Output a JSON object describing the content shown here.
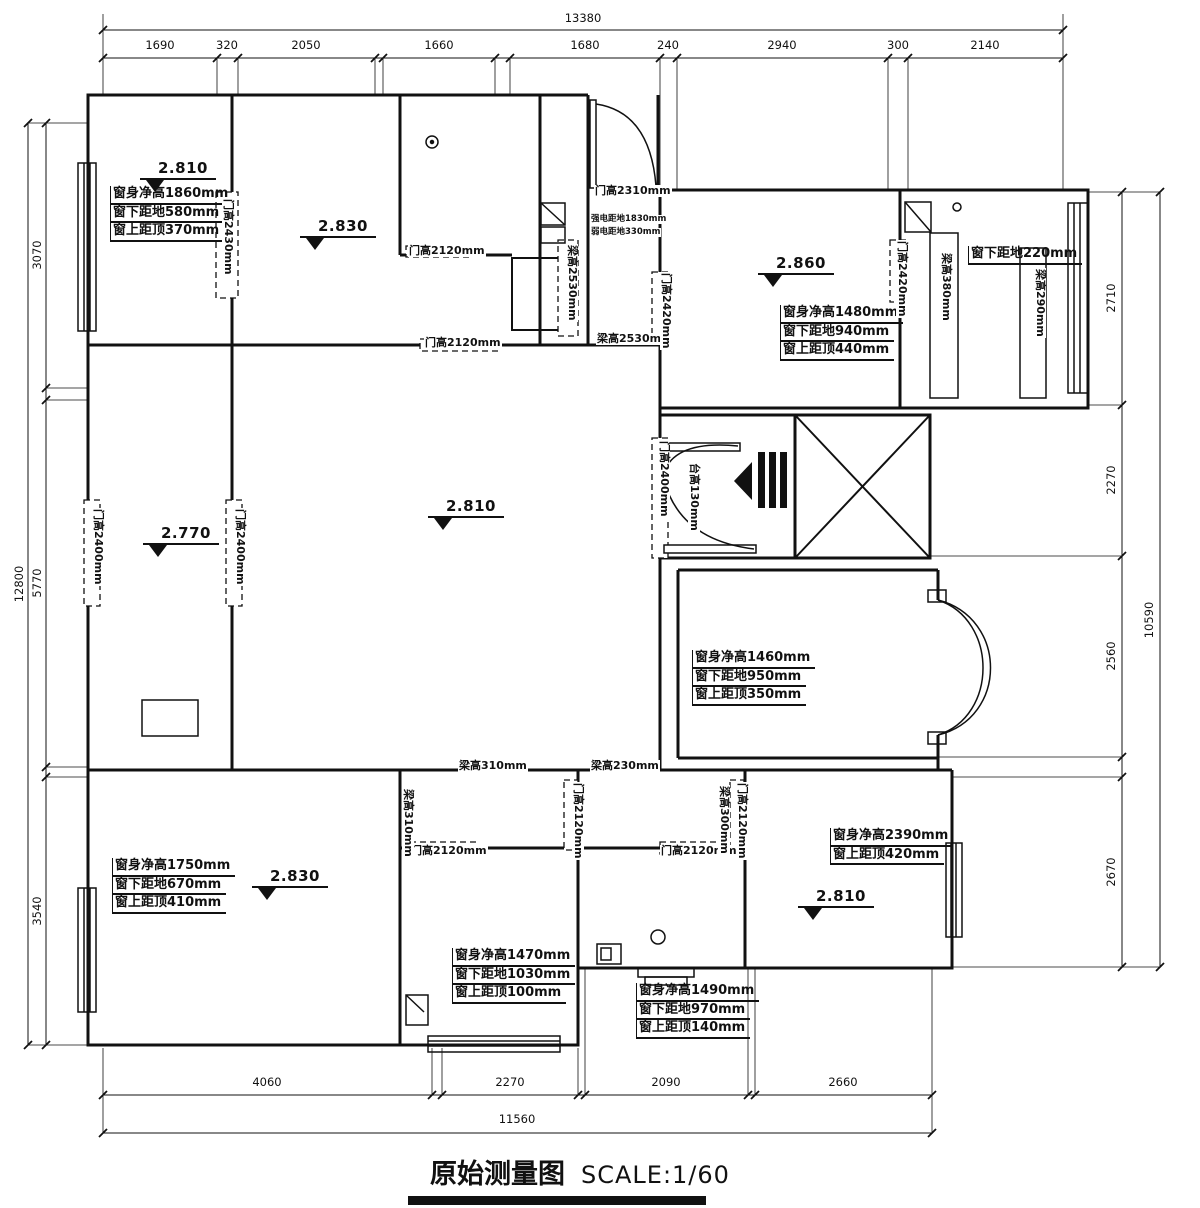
{
  "title": {
    "main": "原始测量图",
    "scale": "SCALE:1/60"
  },
  "dims": {
    "top": {
      "total": "13380",
      "segments": [
        "1690",
        "320",
        "2050",
        "1660",
        "1680",
        "240",
        "2940",
        "300",
        "2140"
      ]
    },
    "left": {
      "total": "12800",
      "segments": [
        "3070",
        "5770",
        "3540"
      ]
    },
    "right": {
      "total": "10590",
      "segments": [
        "2710",
        "2270",
        "2560",
        "2670"
      ]
    },
    "bottom": {
      "total": "11560",
      "segments": [
        "4060",
        "2270",
        "2090",
        "2660"
      ]
    }
  },
  "elevations": {
    "bedroom_top_left": "2.810",
    "room_top_mid": "2.830",
    "living_top_right": "2.860",
    "hallway": "2.770",
    "living_center": "2.810",
    "bedroom_bottom_left": "2.830",
    "bedroom_bottom_right": "2.810"
  },
  "window_annotations": {
    "top_left": [
      "窗身净高1860mm",
      "窗下距地580mm",
      "窗上距顶370mm"
    ],
    "top_right": [
      "窗身净高1480mm",
      "窗下距地940mm",
      "窗上距顶440mm"
    ],
    "balcony": [
      "窗下距地220mm"
    ],
    "mid_right": [
      "窗身净高1460mm",
      "窗下距地950mm",
      "窗上距顶350mm"
    ],
    "bottom_left": [
      "窗身净高1750mm",
      "窗下距地670mm",
      "窗上距顶410mm"
    ],
    "bottom_mid": [
      "窗身净高1470mm",
      "窗下距地1030mm",
      "窗上距顶100mm"
    ],
    "bottom_mid_right": [
      "窗身净高1490mm",
      "窗下距地970mm",
      "窗上距顶140mm"
    ],
    "bottom_right": [
      "窗身净高2390mm",
      "窗上距顶420mm"
    ]
  },
  "feature_labels": {
    "door_top_left": "门高2430mm",
    "door_closet": "门高2120mm",
    "door_room2": "门高2120mm",
    "entry_door_top": "门高2310mm",
    "strong_elec": "强电距地1830mm",
    "weak_elec": "弱电距地330mm",
    "beam_entry_left": "梁高2530mm",
    "beam_entry_bottom": "梁高2530mm",
    "door_entry_right": "门高2420mm",
    "door_hall_left": "门高2400mm",
    "door_hall_right": "门高2400mm",
    "door_main_entry": "门高2400mm",
    "step_entry": "台高130mm",
    "door_balcony": "门高2420mm",
    "beam_balcony_left": "梁高380mm",
    "beam_balcony_right": "梁高290mm",
    "beam_small_room_top": "梁高310mm",
    "beam_small_room_left": "梁高310mm",
    "beam_mid_top": "梁高230mm",
    "door_mid_vertical": "门高2120mm",
    "beam_mid_right": "梁高300mm",
    "door_right_vertical": "门高2120mm",
    "door_bottom_left_bedroom": "门高2120mm",
    "door_bathroom": "门高2120mm"
  }
}
